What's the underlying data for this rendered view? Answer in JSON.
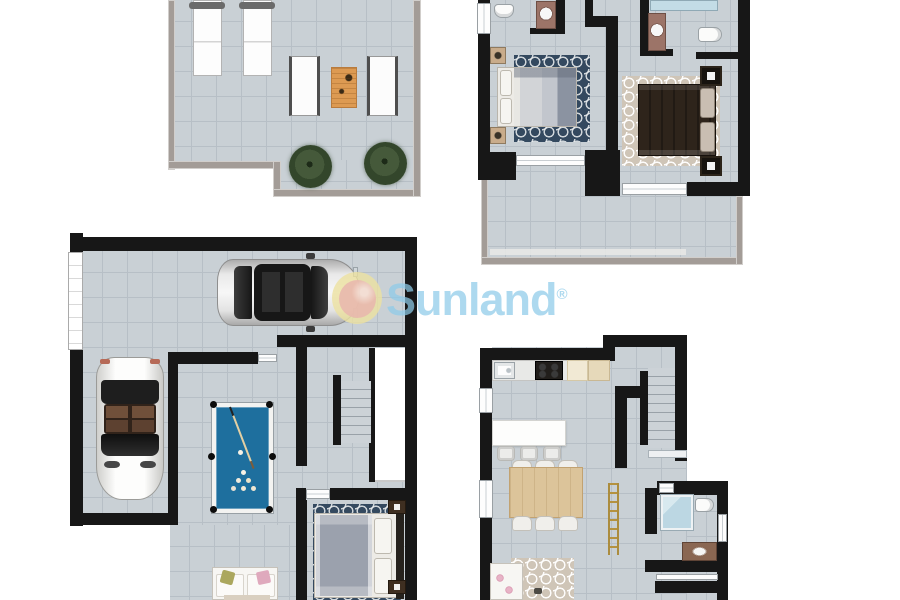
{
  "watermark": {
    "text": "Sunland",
    "registered_mark": "®"
  },
  "colors": {
    "wall": "#171717",
    "terrace_wall": "#a39c97",
    "floor": "#c9d0d5",
    "grout": "#b7bfc6",
    "watermark_blue": "#8ecbe9",
    "logo_yellow": "#ece1a0",
    "logo_pink": "#e9b8ae",
    "pool_felt": "#1e6f9e",
    "rug_blue": "#34495f",
    "rug_beige": "#cfc5b7",
    "wood_table": "#dd9a52",
    "dining_wood": "#dcc49a",
    "vanity_wood": "#8a6752",
    "plant_green": "#45593a",
    "seat_brown": "#70503a"
  },
  "floorplans": {
    "roof_terrace": {
      "id": "roof-terrace-solarium",
      "furniture": [
        "sun-lounger",
        "sun-lounger",
        "deck-chair",
        "deck-chair",
        "wooden-table",
        "potted-plant",
        "potted-plant"
      ]
    },
    "bedroom_floor": {
      "id": "bedroom-floor",
      "rooms": [
        "bedroom-1",
        "bedroom-2",
        "ensuite-1",
        "ensuite-2",
        "balcony"
      ],
      "furniture": [
        "double-bed-blue",
        "double-bed-dark",
        "nightstand",
        "nightstand",
        "nightstand",
        "nightstand",
        "toilet",
        "toilet",
        "washbasin",
        "washbasin",
        "shower",
        "blue-rug",
        "beige-rug"
      ]
    },
    "basement": {
      "id": "basement-garage",
      "rooms": [
        "garage",
        "games-room",
        "bedroom-3",
        "staircase",
        "shaft"
      ],
      "furniture": [
        "sedan-car",
        "convertible-car",
        "billiard-table",
        "cue-stick",
        "billiard-balls",
        "double-bed",
        "sofa",
        "nightstand",
        "nightstand",
        "blue-rug"
      ]
    },
    "ground_floor": {
      "id": "ground-floor-living",
      "rooms": [
        "kitchen-living-room",
        "bathroom",
        "staircase"
      ],
      "furniture": [
        "kitchen-counter",
        "kitchen-sink",
        "cooktop",
        "cabinets",
        "island",
        "bar-stool",
        "bar-stool",
        "bar-stool",
        "dining-table",
        "dining-chairs",
        "decorative-ladder",
        "sofa",
        "beige-rug",
        "shower",
        "toilet",
        "washbasin"
      ]
    }
  }
}
